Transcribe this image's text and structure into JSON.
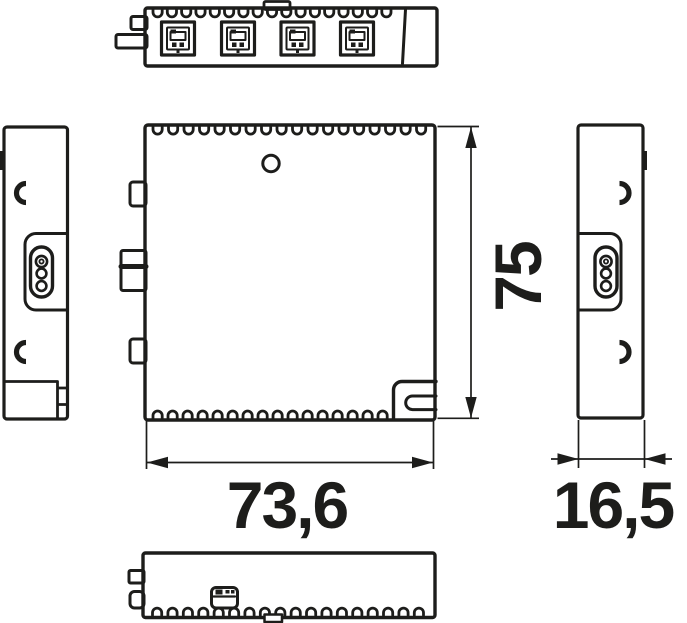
{
  "drawing": {
    "title": "module-dimension-drawing",
    "line_color": "#1d1d1b",
    "background": "#ffffff"
  },
  "dimensions": {
    "width": {
      "value": "73,6"
    },
    "height": {
      "value": "75"
    },
    "depth": {
      "value": "16,5"
    }
  },
  "views": {
    "top": {
      "name": "top-view",
      "vent_count": 17,
      "connector_count": 4
    },
    "front": {
      "name": "front-view",
      "vent_count_top": 18,
      "vent_count_bottom": 16
    },
    "bottom": {
      "name": "bottom-view",
      "vent_count": 18
    },
    "left": {
      "name": "left-side-view"
    },
    "right": {
      "name": "right-side-view"
    }
  }
}
